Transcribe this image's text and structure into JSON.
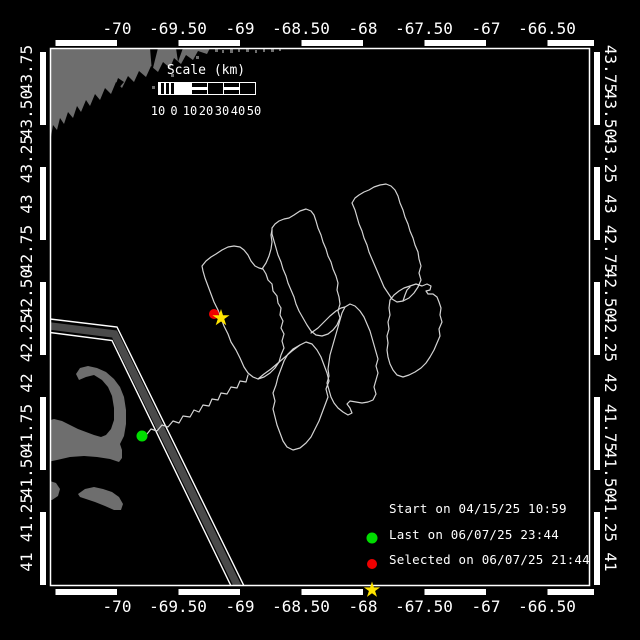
{
  "canvas": {
    "w": 640,
    "h": 640,
    "bg": "#000000",
    "fg": "#ffffff"
  },
  "colors": {
    "land": "#6e6e6e",
    "track": "#d4d4d4",
    "lane_band": "#4a4a4a",
    "frame": "#ffffff"
  },
  "plot_frame": {
    "x": 50.5,
    "y": 48.5,
    "w": 539,
    "h": 537
  },
  "axis": {
    "lon_labels": [
      {
        "t": "-70",
        "x": 117
      },
      {
        "t": "-69.50",
        "x": 178
      },
      {
        "t": "-69",
        "x": 240
      },
      {
        "t": "-68.50",
        "x": 301
      },
      {
        "t": "-68",
        "x": 363
      },
      {
        "t": "-67.50",
        "x": 424
      },
      {
        "t": "-67",
        "x": 486
      },
      {
        "t": "-66.50",
        "x": 547
      }
    ],
    "lat_labels": [
      {
        "t": "43.75",
        "y": 69
      },
      {
        "t": "43.50",
        "y": 114
      },
      {
        "t": "43.25",
        "y": 159
      },
      {
        "t": "43",
        "y": 204
      },
      {
        "t": "42.75",
        "y": 249
      },
      {
        "t": "42.50",
        "y": 293
      },
      {
        "t": "42.25",
        "y": 338
      },
      {
        "t": "42",
        "y": 383
      },
      {
        "t": "41.75",
        "y": 428
      },
      {
        "t": "41.50",
        "y": 473
      },
      {
        "t": "41.25",
        "y": 518
      },
      {
        "t": "41",
        "y": 562
      }
    ],
    "top_y": 29,
    "bottom_y": 607,
    "left_x": 27,
    "right_x": 610
  },
  "scale_bar": {
    "title": "Scale (km)",
    "title_x": 206,
    "title_y": 64,
    "labels": [
      "10",
      "0",
      "10",
      "20",
      "30",
      "40",
      "50"
    ],
    "segments": [
      "hatch",
      "solid",
      "stripe",
      "outline",
      "stripe",
      "outline"
    ],
    "x": 158,
    "y": 82,
    "seg_w": 16,
    "label_y": 105
  },
  "legend": {
    "marker_x": 372,
    "text_x": 391,
    "rows_y": [
      508,
      534,
      559
    ],
    "items": [
      {
        "marker": "circle",
        "color": "#00dc00",
        "label": "Start on 04/15/25 10:59"
      },
      {
        "marker": "circle",
        "color": "#ee0000",
        "label": "Last on 06/07/25 23:44"
      },
      {
        "marker": "star",
        "color": "#ffe400",
        "label": "Selected on 06/07/25 21:44"
      }
    ]
  },
  "markers": {
    "start": {
      "x": 142,
      "y": 436,
      "r": 5.5,
      "color": "#00dc00"
    },
    "last": {
      "x": 214,
      "y": 314,
      "r": 5,
      "color": "#ee0000"
    },
    "selected": {
      "x": 221,
      "y": 318,
      "r": 9,
      "color": "#ffe400"
    }
  },
  "geometry": {
    "land_paths": [
      "M50,48 L210,48 L207,54 L198,51 L193,60 L186,55 L181,64 L174,58 L170,68 L163,62 L158,72 L151,66 L146,77 L139,71 L134,82 L128,76 L122,88 L116,82 L111,94 L105,88 L100,100 L95,94 L90,106 L86,100 L81,112 L77,106 L73,118 L68,112 L64,124 L60,118 L57,130 L53,125 L51,137 L50,158 Z",
      "M47,421 L54,419 L62,421 L70,425 L78,429 L86,432 L94,435 L101,437 L106,435 L111,429 L114,420 L114,408 L112,396 L108,387 L102,380 L94,375 L86,377 L79,380 L76,374 L80,368 L88,366 L97,368 L106,372 L114,379 L120,387 L124,397 L126,410 L126,424 L124,436 L120,444 L122,450 L122,458 L119,462 L110,459 L97,457 L84,456 L70,457 L57,460 L47,462 Z",
      "M50,481 L56,483 L60,489 L58,496 L52,500 L47,500 L47,483 Z",
      "M78,494 L85,489 L94,487 L103,489 L112,492 L119,497 L123,504 L121,510 L114,510 L105,506 L95,502 L86,499 L80,497 Z"
    ],
    "land_notches": [
      "M150,48 L158,48 L152,72 Z",
      "M176,48 L183,48 L178,62 Z",
      "M118,78 L124,82 L112,96 Z"
    ],
    "speckles": [
      [
        215,
        48,
        3,
        4
      ],
      [
        222,
        50,
        2,
        3
      ],
      [
        230,
        48,
        3,
        5
      ],
      [
        238,
        49,
        2,
        3
      ],
      [
        246,
        48,
        3,
        4
      ],
      [
        255,
        50,
        2,
        3
      ],
      [
        263,
        48,
        2,
        4
      ],
      [
        271,
        49,
        3,
        3
      ],
      [
        279,
        48,
        2,
        3
      ],
      [
        196,
        56,
        3,
        3
      ],
      [
        171,
        74,
        3,
        3
      ],
      [
        152,
        86,
        3,
        3
      ]
    ],
    "lane_band": "M50,326 L114.5,334 L239.5,590",
    "lane_lines": [
      "M50,319 L117,327 L246,590",
      "M50,332.5 L112,340.5 L233,590"
    ],
    "track_paths": [
      "M142,436 L147,434 L151,429 L157,431 L162,425 L168,427 L173,421 L179,423 L183,416 L190,417 L194,410 L199,412 L203,405 L209,406 L212,399 L218,400 L221,393 L227,394 L231,387 L237,388 L240,381 L246,382 L248,375",
      "M248,373 L244,367 L240,358 L236,350 L231,342 L228,334 L224,326 L221,318 L218,310 L214,302 L211,294 L208,286 L205,278 L203,271 L202,266 L206,261 L211,257 L216,254 L222,250 L228,247 L234,246 L240,247 L244,250 L248,255 L251,261 L255,266 L259,268 L263,269 L266,274 L268,280 L272,284 L273,291 L277,296 L278,303 L281,308 L280,315 L283,321 L281,328 L284,334 L282,341 L284,348 L281,355 L279,362 L275,368 L270,373 L264,377 L258,379 L253,377 L248,373 Z",
      "M272,228 L275,224 L279,221 L284,219 L289,218 L294,215 L300,211 L306,209 L311,211 L314,215 L316,221 L318,228 L321,235 L323,242 L326,249 L328,256 L331,262 L333,269 L336,276 L338,283 L337,290 L339,297 L340,304 L338,311 L340,318 L337,325 L333,330 L328,334 L322,336 L316,335 L311,331 L307,325 L303,318 L299,311 L296,304 L294,297 L291,290 L288,283 L286,276 L283,269 L281,262 L278,255 L276,248 L274,241 L272,234 Z",
      "M352,203 L355,198 L359,195 L364,192 L369,190 L374,187 L380,185 L386,184 L391,186 L395,190 L398,196 L400,203 L403,210 L405,217 L408,224 L410,231 L413,238 L415,245 L418,252 L419,259 L421,266 L419,273 L421,280 L418,287 L414,293 L409,298 L403,301 L397,302 L392,299 L388,293 L384,287 L381,280 L378,273 L375,266 L372,259 L369,252 L367,245 L364,238 L362,231 L359,224 L357,217 L355,210 Z",
      "M300,345 L306,342 L312,344 L317,350 L321,357 L324,365 L327,373 L329,381 L326,389 L328,397 L325,405 L322,413 L319,421 L315,429 L311,437 L306,443 L300,448 L293,450 L287,447 L283,441 L280,433 L277,425 L275,417 L273,409 L275,401 L273,393 L276,385 L278,377 L281,369 L284,361 L288,354 L293,349 Z",
      "M345,307 L342,313 L340,320 L338,327 L336,334 L334,341 L332,348 L330,355 L329,362 L328,369 L329,376 L327,383 L329,390 L331,397 L334,403 L338,408 L343,412 L348,415 L352,413 L350,408 L347,404 L350,401 L356,402 L362,403 L368,402 L373,400 L376,394 L374,387 L376,380 L378,373 L376,366 L378,359 L376,352 L374,345 L372,338 L370,331 L367,324 L364,317 L360,311 L355,306 L350,304 L345,307 Z",
      "M390,300 L394,295 L399,291 L404,288 L410,286 L416,284 L422,286 L427,284 L431,286 L430,290 L426,291 L428,294 L433,294 L437,297 L439,302 L441,308 L440,315 L442,322 L439,329 L440,336 L437,343 L434,350 L430,357 L426,363 L421,368 L415,372 L409,375 L403,377 L397,375 L393,370 L390,364 L388,357 L387,350 L388,343 L387,336 L389,329 L388,322 L390,315 L389,308 Z",
      "M262,269 L266,263 L269,256 L271,249 L272,242 L271,235 L272,230",
      "M258,379 L264,374 L271,369 L278,363 L285,357 L292,351 L300,345",
      "M311,333 L318,328 L324,322 L330,316 L336,311 L341,308 L345,307",
      "M403,301 L405,295 L407,290 L410,287"
    ]
  },
  "border_bars": {
    "top": {
      "y": 43,
      "dash": [
        61.5,
        61.5
      ],
      "offset": -77
    },
    "bottom": {
      "y": 592,
      "dash": [
        61.5,
        61.5
      ],
      "offset": -77
    },
    "left": {
      "x": 43,
      "dash": [
        42,
        73
      ],
      "offset": -85
    },
    "right": {
      "x": 597,
      "dash": [
        42,
        73
      ],
      "offset": -85
    }
  }
}
